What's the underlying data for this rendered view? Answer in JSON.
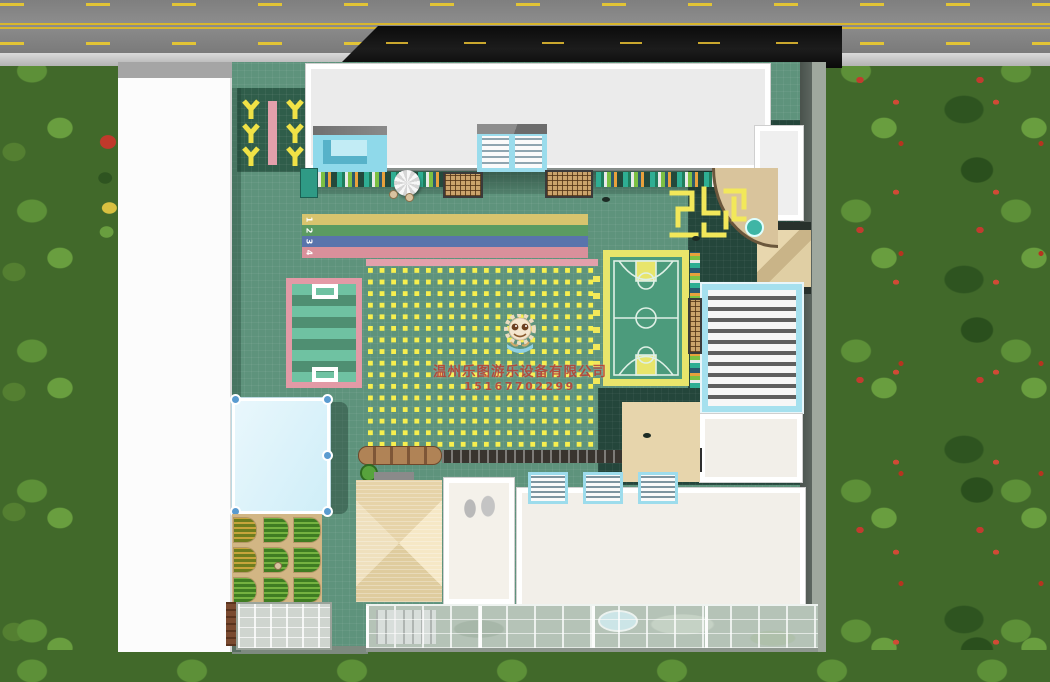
{
  "watermark": {
    "logo_icon": "mascot-logo",
    "company_name": "温州乐图游乐设备有限公司",
    "phone": "15167702299"
  },
  "track": {
    "lanes": [
      {
        "number": "1",
        "color": "#d8c46e"
      },
      {
        "number": "2",
        "color": "#5b9b62"
      },
      {
        "number": "3",
        "color": "#5974ac"
      },
      {
        "number": "4",
        "color": "#d9909b"
      }
    ]
  },
  "colors": {
    "ground_tiles": "#5e937c",
    "dark_tiles": "#24463b",
    "court_border_yellow": "#e8e56b",
    "court_green": "#4c9b7c",
    "soccer_border_pink": "#e39aa6",
    "dot_grid_yellow": "#f7ef4e",
    "pool_blue": "#cfeef8",
    "sand_tan": "#e7d5ac",
    "roof_white": "#f2efe9",
    "cyan_structures": "#8fd9ea",
    "road_gray": "#8d8d8d",
    "road_dark": "#111111",
    "road_line_yellow": "#d8b62e",
    "grass_green": "#41692a"
  }
}
